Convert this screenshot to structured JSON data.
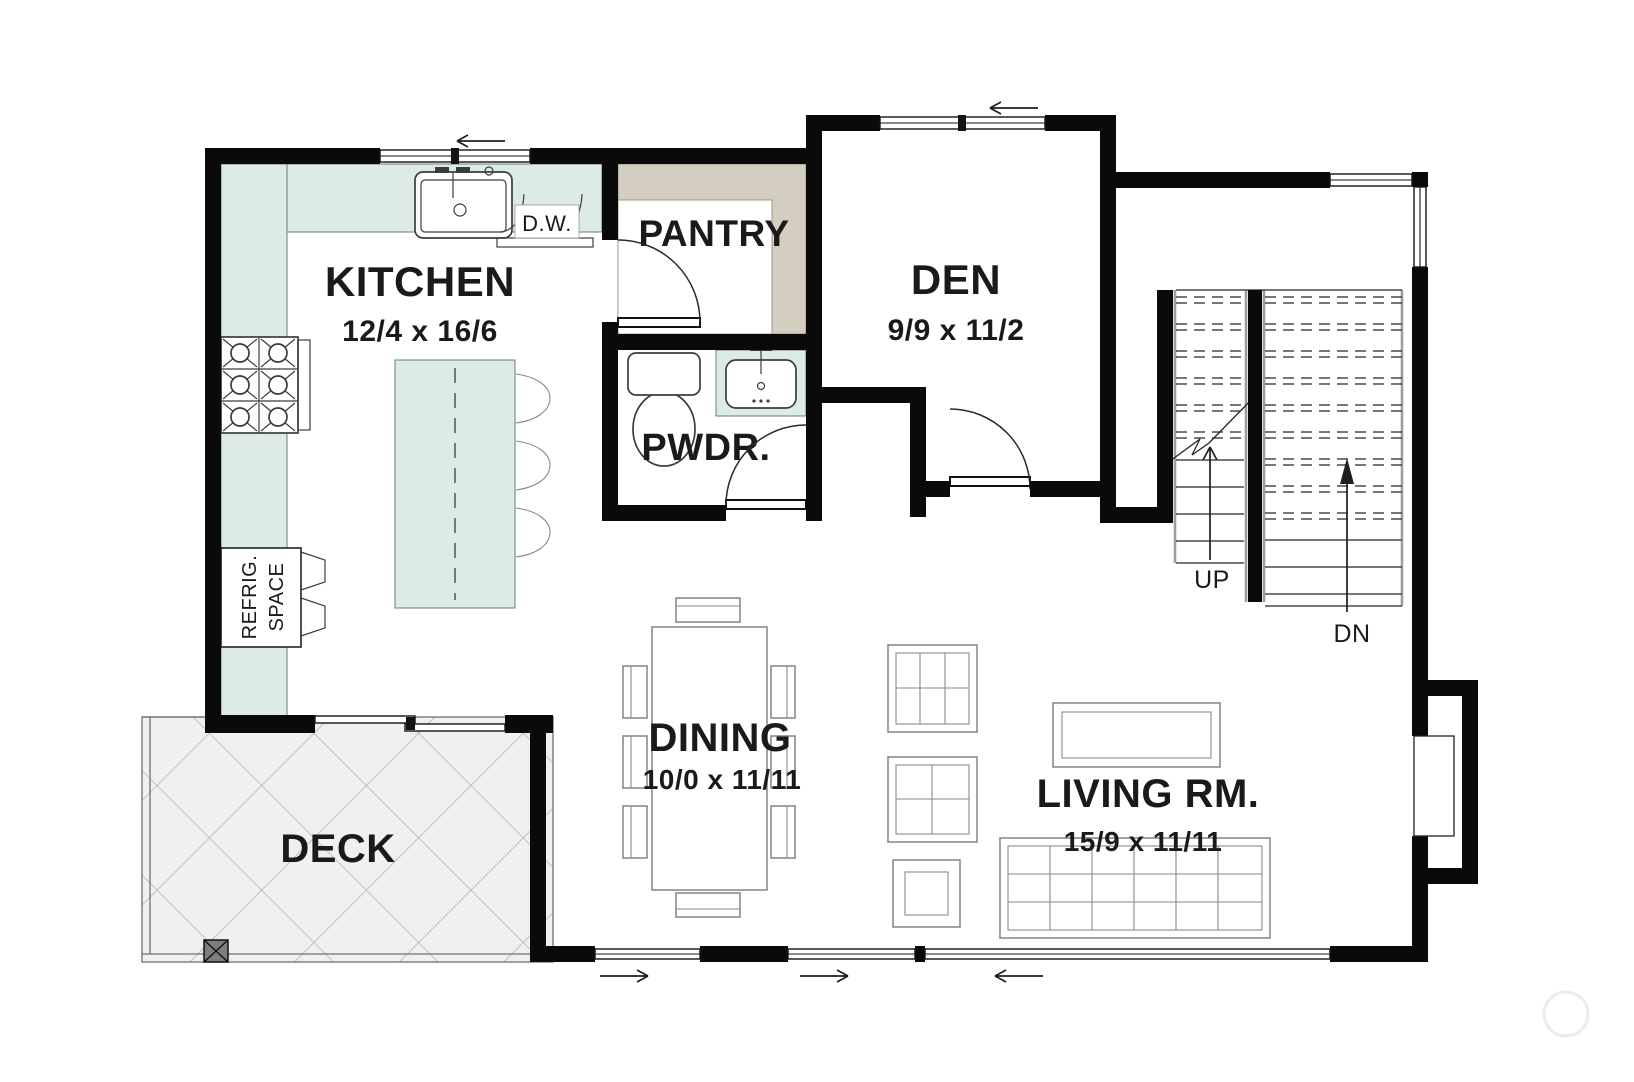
{
  "rooms": {
    "kitchen": {
      "label": "KITCHEN",
      "dims": "12/4 x 16/6"
    },
    "pantry": {
      "label": "PANTRY"
    },
    "den": {
      "label": "DEN",
      "dims": "9/9 x 11/2"
    },
    "powder": {
      "label": "PWDR."
    },
    "dining": {
      "label": "DINING",
      "dims": "10/0 x 11/11"
    },
    "living": {
      "label": "LIVING RM.",
      "dims": "15/9 x 11/11"
    },
    "deck": {
      "label": "DECK"
    }
  },
  "fixtures": {
    "dishwasher": "D.W.",
    "refrigerator": {
      "line1": "REFRIG.",
      "line2": "SPACE"
    }
  },
  "stairs": {
    "up": "UP",
    "down": "DN"
  },
  "colors": {
    "wall": "#0a0a0a",
    "counter": "#dcebe7",
    "counter_stroke": "#6a7c7a",
    "pantry_shelf": "#d3cec0",
    "deck_fill": "#f0f0f0",
    "deck_hatch": "#b3b3b3",
    "furniture": "#8a8a8a",
    "fixture": "#3c3c3c",
    "text": "#1a1a1a"
  }
}
